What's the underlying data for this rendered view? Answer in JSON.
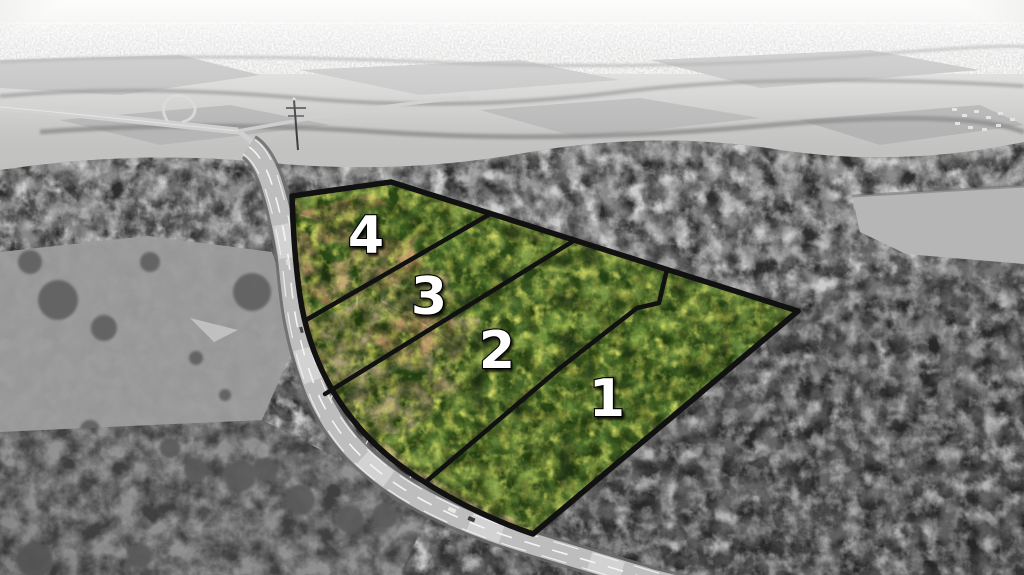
{
  "image": {
    "kind": "aerial drone photograph of land for sale",
    "treatment": "four numbered parcels shown in color with black boundary lines over a desaturated grayscale landscape",
    "parcel_count": 4
  },
  "lots": [
    {
      "id": 1,
      "label": "1"
    },
    {
      "id": 2,
      "label": "2"
    },
    {
      "id": 3,
      "label": "3"
    },
    {
      "id": 4,
      "label": "4"
    }
  ],
  "colors": {
    "boundary": "#111111",
    "lot_label_fill": "#ffffff",
    "lot_label_outline": "#000000",
    "canopy_green": "#7e9a47",
    "canopy_green_dark": "#2c4517",
    "canopy_highlight": "#c8d05e",
    "dirt_tan": "#bc9369",
    "pasture_olive": "#ab9d74",
    "road_surface": "#bdbdbd",
    "grayscale_forest": "#7f7f7f",
    "haze_white": "#f0efec"
  }
}
